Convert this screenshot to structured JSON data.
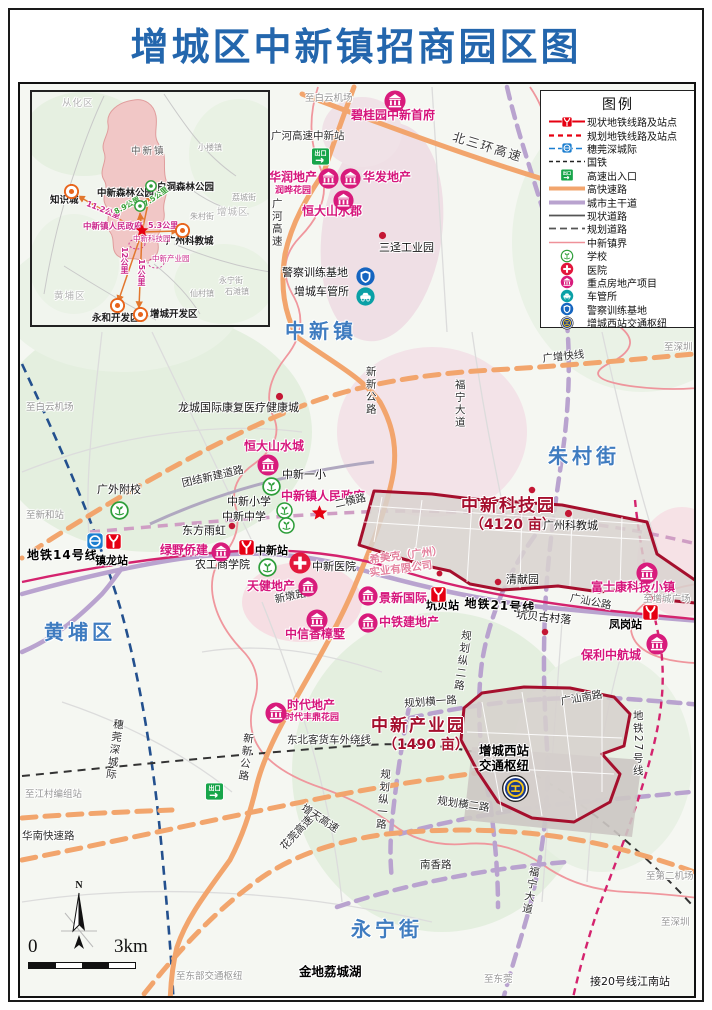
{
  "title": "增城区中新镇招商园区图",
  "legend": {
    "title": "图例",
    "items": [
      {
        "label": "现状地铁线路及站点",
        "swatch": "metro-existing"
      },
      {
        "label": "规划地铁线路及站点",
        "swatch": "metro-planned"
      },
      {
        "label": "穗莞深城际",
        "swatch": "intercity"
      },
      {
        "label": "国铁",
        "swatch": "national-rail"
      },
      {
        "label": "高速出入口",
        "swatch": "exit"
      },
      {
        "label": "高快速路",
        "swatch": "expressway"
      },
      {
        "label": "城市主干道",
        "swatch": "arterial"
      },
      {
        "label": "现状道路",
        "swatch": "road-existing"
      },
      {
        "label": "规划道路",
        "swatch": "road-planned"
      },
      {
        "label": "中新镇界",
        "swatch": "boundary"
      },
      {
        "label": "学校",
        "swatch": "school"
      },
      {
        "label": "医院",
        "swatch": "hospital"
      },
      {
        "label": "重点房地产项目",
        "swatch": "realestate"
      },
      {
        "label": "车管所",
        "swatch": "dmv"
      },
      {
        "label": "警察训练基地",
        "swatch": "police"
      },
      {
        "label": "增城西站交通枢纽",
        "swatch": "hub"
      }
    ]
  },
  "colors": {
    "title": "#2366ad",
    "park_outline": "#a50f2d",
    "realestate": "#d6167c",
    "expressway": "#f2a56d",
    "arterial": "#b9a3cf",
    "metro": "#d4236e",
    "intercity": "#23508e",
    "boundary": "#ef9199"
  },
  "scalebar": {
    "zero": "0",
    "end": "3km",
    "north": "N"
  },
  "inset": {
    "labels": [
      {
        "t": "从化区",
        "x": 58,
        "y": 95,
        "cls": "ig2"
      },
      {
        "t": "中新镇",
        "x": 127,
        "y": 143,
        "cls": "ib"
      },
      {
        "t": "小楼镇",
        "x": 194,
        "y": 140,
        "cls": "ig"
      },
      {
        "t": "荔城街",
        "x": 228,
        "y": 190,
        "cls": "ig"
      },
      {
        "t": "朱村街",
        "x": 186,
        "y": 209,
        "cls": "ig"
      },
      {
        "t": "增城区",
        "x": 213,
        "y": 204,
        "cls": "ig2"
      },
      {
        "t": "知识城",
        "x": 46,
        "y": 192,
        "cls": "ibk"
      },
      {
        "t": "中新森林公园",
        "x": 93,
        "y": 185,
        "cls": "ibk"
      },
      {
        "t": "白洞森林公园",
        "x": 153,
        "y": 179,
        "cls": "ibk"
      },
      {
        "t": "11.2公里",
        "x": 84,
        "y": 196,
        "cls": "imd",
        "rot": 22
      },
      {
        "t": "8.9公里",
        "x": 109,
        "y": 205,
        "cls": "igd",
        "rot": -28
      },
      {
        "t": "7.5公里",
        "x": 138,
        "y": 198,
        "cls": "igd",
        "rot": -35
      },
      {
        "t": "中新镇人民政府",
        "x": 79,
        "y": 219,
        "cls": "imd2"
      },
      {
        "t": "5.3公里",
        "x": 144,
        "y": 218,
        "cls": "imd"
      },
      {
        "t": "广州科教城",
        "x": 162,
        "y": 233,
        "cls": "ibk"
      },
      {
        "t": "中新科技园",
        "x": 129,
        "y": 231,
        "cls": "imt"
      },
      {
        "t": "中新产业园",
        "x": 148,
        "y": 251,
        "cls": "imt"
      },
      {
        "t": "12公里",
        "x": 115,
        "y": 243,
        "cls": "imdv"
      },
      {
        "t": "15公里",
        "x": 132,
        "y": 255,
        "cls": "imdv"
      },
      {
        "t": "永宁街",
        "x": 215,
        "y": 273,
        "cls": "ig"
      },
      {
        "t": "仙村镇",
        "x": 186,
        "y": 286,
        "cls": "ig"
      },
      {
        "t": "石滩镇",
        "x": 221,
        "y": 284,
        "cls": "ig"
      },
      {
        "t": "黄埔区",
        "x": 50,
        "y": 288,
        "cls": "ig2"
      },
      {
        "t": "永和开发区",
        "x": 88,
        "y": 310,
        "cls": "ibk"
      },
      {
        "t": "增城开发区",
        "x": 146,
        "y": 306,
        "cls": "ibk"
      }
    ],
    "icons": [
      {
        "type": "ringO",
        "x": 60,
        "y": 180,
        "s": 15
      },
      {
        "type": "ringO",
        "x": 171,
        "y": 219,
        "s": 15
      },
      {
        "type": "ringO",
        "x": 106,
        "y": 294,
        "s": 15
      },
      {
        "type": "ringO",
        "x": 129,
        "y": 303,
        "s": 15
      },
      {
        "type": "greenpark",
        "x": 130,
        "y": 196,
        "s": 12
      },
      {
        "type": "greenpark",
        "x": 141,
        "y": 176,
        "s": 12
      },
      {
        "type": "star",
        "x": 131,
        "y": 219,
        "s": 14
      }
    ]
  },
  "map": {
    "labels": [
      {
        "t": "至白云机场",
        "x": 303,
        "y": 92,
        "cls": "g"
      },
      {
        "t": "碧桂园中新首府",
        "x": 349,
        "y": 107,
        "cls": "m"
      },
      {
        "t": "广河高速中新站",
        "x": 269,
        "y": 129,
        "cls": "r"
      },
      {
        "t": "北三环高速",
        "x": 453,
        "y": 128,
        "cls": "r rbig",
        "rot": 17
      },
      {
        "t": "华润地产",
        "x": 267,
        "y": 169,
        "cls": "m"
      },
      {
        "t": "润晔花园",
        "x": 273,
        "y": 184,
        "cls": "m2"
      },
      {
        "t": "华发地产",
        "x": 361,
        "y": 169,
        "cls": "m"
      },
      {
        "t": "恒大山水郡",
        "x": 300,
        "y": 203,
        "cls": "m"
      },
      {
        "t": "广河高速",
        "x": 268,
        "y": 196,
        "cls": "rv"
      },
      {
        "t": "三迳工业园",
        "x": 377,
        "y": 240,
        "cls": "bk"
      },
      {
        "t": "警察训练基地",
        "x": 280,
        "y": 265,
        "cls": "bk"
      },
      {
        "t": "增城车管所",
        "x": 292,
        "y": 284,
        "cls": "bk"
      },
      {
        "t": "中新镇",
        "x": 283,
        "y": 318,
        "cls": "blue"
      },
      {
        "t": "至深圳",
        "x": 662,
        "y": 341,
        "cls": "g"
      },
      {
        "t": "广增快线",
        "x": 540,
        "y": 352,
        "cls": "r",
        "rot": -6
      },
      {
        "t": "新新公路",
        "x": 362,
        "y": 364,
        "cls": "rv"
      },
      {
        "t": "福宁大道",
        "x": 451,
        "y": 377,
        "cls": "rv"
      },
      {
        "t": "至白云机场",
        "x": 24,
        "y": 401,
        "cls": "g"
      },
      {
        "t": "龙城国际康复医疗健康城",
        "x": 176,
        "y": 400,
        "cls": "bk"
      },
      {
        "t": "朱村街",
        "x": 546,
        "y": 443,
        "cls": "blue"
      },
      {
        "t": "恒大山水城",
        "x": 242,
        "y": 438,
        "cls": "m"
      },
      {
        "t": "中新一小",
        "x": 280,
        "y": 467,
        "cls": "bk"
      },
      {
        "t": "团结新建道路",
        "x": 179,
        "y": 477,
        "cls": "r",
        "rot": -13
      },
      {
        "t": "广外附校",
        "x": 95,
        "y": 482,
        "cls": "bk"
      },
      {
        "t": "中新镇人民政府",
        "x": 279,
        "y": 488,
        "cls": "m"
      },
      {
        "t": "二横路",
        "x": 332,
        "y": 498,
        "cls": "r",
        "rot": -13
      },
      {
        "t": "中新小学",
        "x": 225,
        "y": 494,
        "cls": "bk"
      },
      {
        "t": "中新中学",
        "x": 220,
        "y": 509,
        "cls": "bk"
      },
      {
        "t": "中新科技园",
        "x": 459,
        "y": 495,
        "cls": "park"
      },
      {
        "t": "（4120 亩）",
        "x": 468,
        "y": 516,
        "cls": "park2"
      },
      {
        "t": "至新和站",
        "x": 24,
        "y": 509,
        "cls": "g"
      },
      {
        "t": "广州科教城",
        "x": 541,
        "y": 518,
        "cls": "bk"
      },
      {
        "t": "东方雨虹",
        "x": 180,
        "y": 523,
        "cls": "bk"
      },
      {
        "t": "地铁14号线",
        "x": 25,
        "y": 547,
        "cls": "rb"
      },
      {
        "t": "镇龙站",
        "x": 93,
        "y": 553,
        "cls": "st"
      },
      {
        "t": "中新站",
        "x": 253,
        "y": 543,
        "cls": "st"
      },
      {
        "t": "绿野侨建",
        "x": 158,
        "y": 542,
        "cls": "m"
      },
      {
        "t": "希美克（广州）",
        "x": 367,
        "y": 553,
        "cls": "pk",
        "rot": -7
      },
      {
        "t": "实业有限公司",
        "x": 367,
        "y": 566,
        "cls": "pk",
        "rot": -7
      },
      {
        "t": "农工商学院",
        "x": 193,
        "y": 557,
        "cls": "bk"
      },
      {
        "t": "中新医院",
        "x": 310,
        "y": 559,
        "cls": "bk"
      },
      {
        "t": "清献园",
        "x": 504,
        "y": 572,
        "cls": "bk"
      },
      {
        "t": "天健地产",
        "x": 245,
        "y": 578,
        "cls": "m"
      },
      {
        "t": "富士康科技小镇",
        "x": 589,
        "y": 579,
        "cls": "m"
      },
      {
        "t": "至增城广场",
        "x": 641,
        "y": 593,
        "cls": "g"
      },
      {
        "t": "广汕公路",
        "x": 569,
        "y": 591,
        "cls": "r",
        "rot": 11
      },
      {
        "t": "景新国际",
        "x": 377,
        "y": 590,
        "cls": "m"
      },
      {
        "t": "新墩路",
        "x": 272,
        "y": 593,
        "cls": "r",
        "rot": -12
      },
      {
        "t": "坑贝站",
        "x": 424,
        "y": 598,
        "cls": "st"
      },
      {
        "t": "地铁21号线",
        "x": 463,
        "y": 595,
        "cls": "rb",
        "rot": 4
      },
      {
        "t": "凤岗站",
        "x": 607,
        "y": 617,
        "cls": "st"
      },
      {
        "t": "坑贝古村落",
        "x": 515,
        "y": 607,
        "cls": "bk",
        "rot": 6
      },
      {
        "t": "中铁建地产",
        "x": 377,
        "y": 614,
        "cls": "m"
      },
      {
        "t": "黄埔区",
        "x": 42,
        "y": 619,
        "cls": "blue"
      },
      {
        "t": "中信香樟墅",
        "x": 283,
        "y": 626,
        "cls": "m"
      },
      {
        "t": "规划纵二路",
        "x": 458,
        "y": 627,
        "cls": "rv",
        "rot": 8
      },
      {
        "t": "保利中航城",
        "x": 579,
        "y": 647,
        "cls": "m"
      },
      {
        "t": "地铁27号线",
        "x": 629,
        "y": 708,
        "cls": "rv"
      },
      {
        "t": "广汕南路",
        "x": 558,
        "y": 695,
        "cls": "r",
        "rot": -10
      },
      {
        "t": "时代地产",
        "x": 285,
        "y": 697,
        "cls": "m"
      },
      {
        "t": "时代丰鼎花园",
        "x": 283,
        "y": 711,
        "cls": "m2"
      },
      {
        "t": "规划横一路",
        "x": 402,
        "y": 697,
        "cls": "r",
        "rot": -4
      },
      {
        "t": "中新产业园",
        "x": 369,
        "y": 715,
        "cls": "park"
      },
      {
        "t": "（1490 亩）",
        "x": 381,
        "y": 736,
        "cls": "park2"
      },
      {
        "t": "新新公路",
        "x": 240,
        "y": 730,
        "cls": "rv",
        "rot": 7
      },
      {
        "t": "东北客货车外绕线",
        "x": 285,
        "y": 733,
        "cls": "r"
      },
      {
        "t": "增城西站",
        "x": 477,
        "y": 742,
        "cls": "bkb"
      },
      {
        "t": "交通枢纽",
        "x": 477,
        "y": 757,
        "cls": "bkb"
      },
      {
        "t": "规划纵一路",
        "x": 377,
        "y": 766,
        "cls": "rv",
        "rot": 5
      },
      {
        "t": "穗莞深城际",
        "x": 110,
        "y": 716,
        "cls": "rv",
        "rot": 8
      },
      {
        "t": "至江村编组站",
        "x": 23,
        "y": 788,
        "cls": "g"
      },
      {
        "t": "规划横二路",
        "x": 436,
        "y": 794,
        "cls": "r",
        "rot": 8
      },
      {
        "t": "增天高速",
        "x": 303,
        "y": 801,
        "cls": "r",
        "rot": 33
      },
      {
        "t": "华南快速路",
        "x": 20,
        "y": 829,
        "cls": "r"
      },
      {
        "t": "花莞高速",
        "x": 277,
        "y": 843,
        "cls": "r",
        "rot": -47
      },
      {
        "t": "南香路",
        "x": 418,
        "y": 858,
        "cls": "r"
      },
      {
        "t": "福宁大道",
        "x": 526,
        "y": 863,
        "cls": "rv",
        "rot": 10
      },
      {
        "t": "至第二机场",
        "x": 644,
        "y": 870,
        "cls": "g"
      },
      {
        "t": "至深圳",
        "x": 659,
        "y": 916,
        "cls": "g"
      },
      {
        "t": "永宁街",
        "x": 349,
        "y": 916,
        "cls": "blue"
      },
      {
        "t": "金地荔城湖",
        "x": 297,
        "y": 963,
        "cls": "bkb"
      },
      {
        "t": "至东部交通枢纽",
        "x": 174,
        "y": 970,
        "cls": "g"
      },
      {
        "t": "至东莞",
        "x": 482,
        "y": 973,
        "cls": "g"
      },
      {
        "t": "接20号线江南站",
        "x": 588,
        "y": 974,
        "cls": "bk"
      }
    ],
    "icons": [
      {
        "type": "building",
        "x": 382,
        "y": 88,
        "s": 22
      },
      {
        "type": "building",
        "x": 316,
        "y": 166,
        "s": 21
      },
      {
        "type": "building",
        "x": 338,
        "y": 166,
        "s": 21
      },
      {
        "type": "building",
        "x": 331,
        "y": 188,
        "s": 21
      },
      {
        "type": "building",
        "x": 255,
        "y": 452,
        "s": 22
      },
      {
        "type": "building",
        "x": 209,
        "y": 540,
        "s": 20
      },
      {
        "type": "building",
        "x": 296,
        "y": 575,
        "s": 20
      },
      {
        "type": "building",
        "x": 356,
        "y": 584,
        "s": 20
      },
      {
        "type": "building",
        "x": 356,
        "y": 611,
        "s": 20
      },
      {
        "type": "building",
        "x": 304,
        "y": 607,
        "s": 22
      },
      {
        "type": "building",
        "x": 263,
        "y": 700,
        "s": 22
      },
      {
        "type": "building",
        "x": 634,
        "y": 560,
        "s": 22
      },
      {
        "type": "building",
        "x": 644,
        "y": 631,
        "s": 22
      },
      {
        "type": "school",
        "x": 108,
        "y": 499,
        "s": 19
      },
      {
        "type": "school",
        "x": 260,
        "y": 475,
        "s": 19
      },
      {
        "type": "school",
        "x": 274,
        "y": 500,
        "s": 17
      },
      {
        "type": "school",
        "x": 276,
        "y": 515,
        "s": 17
      },
      {
        "type": "school",
        "x": 256,
        "y": 556,
        "s": 19
      },
      {
        "type": "hospital",
        "x": 287,
        "y": 550,
        "s": 22
      },
      {
        "type": "metrob",
        "x": 84,
        "y": 530,
        "s": 18
      },
      {
        "type": "metro",
        "x": 103,
        "y": 531,
        "s": 17
      },
      {
        "type": "metro",
        "x": 236,
        "y": 537,
        "s": 17
      },
      {
        "type": "metro",
        "x": 428,
        "y": 584,
        "s": 17
      },
      {
        "type": "metro",
        "x": 640,
        "y": 602,
        "s": 17
      },
      {
        "type": "exit",
        "x": 309,
        "y": 145,
        "s": 19
      },
      {
        "type": "exit",
        "x": 203,
        "y": 780,
        "s": 19
      },
      {
        "type": "police",
        "x": 354,
        "y": 265,
        "s": 19
      },
      {
        "type": "dmv",
        "x": 354,
        "y": 285,
        "s": 19
      },
      {
        "type": "hub",
        "x": 500,
        "y": 773,
        "s": 27
      },
      {
        "type": "star",
        "x": 309,
        "y": 502,
        "s": 17
      },
      {
        "type": "dot",
        "x": 375,
        "y": 228,
        "s": 11
      },
      {
        "type": "dot",
        "x": 225,
        "y": 519,
        "s": 10
      },
      {
        "type": "dot",
        "x": 272,
        "y": 389,
        "s": 11
      },
      {
        "type": "dot",
        "x": 561,
        "y": 506,
        "s": 11
      },
      {
        "type": "dot",
        "x": 491,
        "y": 575,
        "s": 10
      },
      {
        "type": "dot",
        "x": 538,
        "y": 625,
        "s": 10
      },
      {
        "type": "dot",
        "x": 525,
        "y": 483,
        "s": 10
      },
      {
        "type": "dot",
        "x": 433,
        "y": 567,
        "s": 9
      }
    ]
  }
}
